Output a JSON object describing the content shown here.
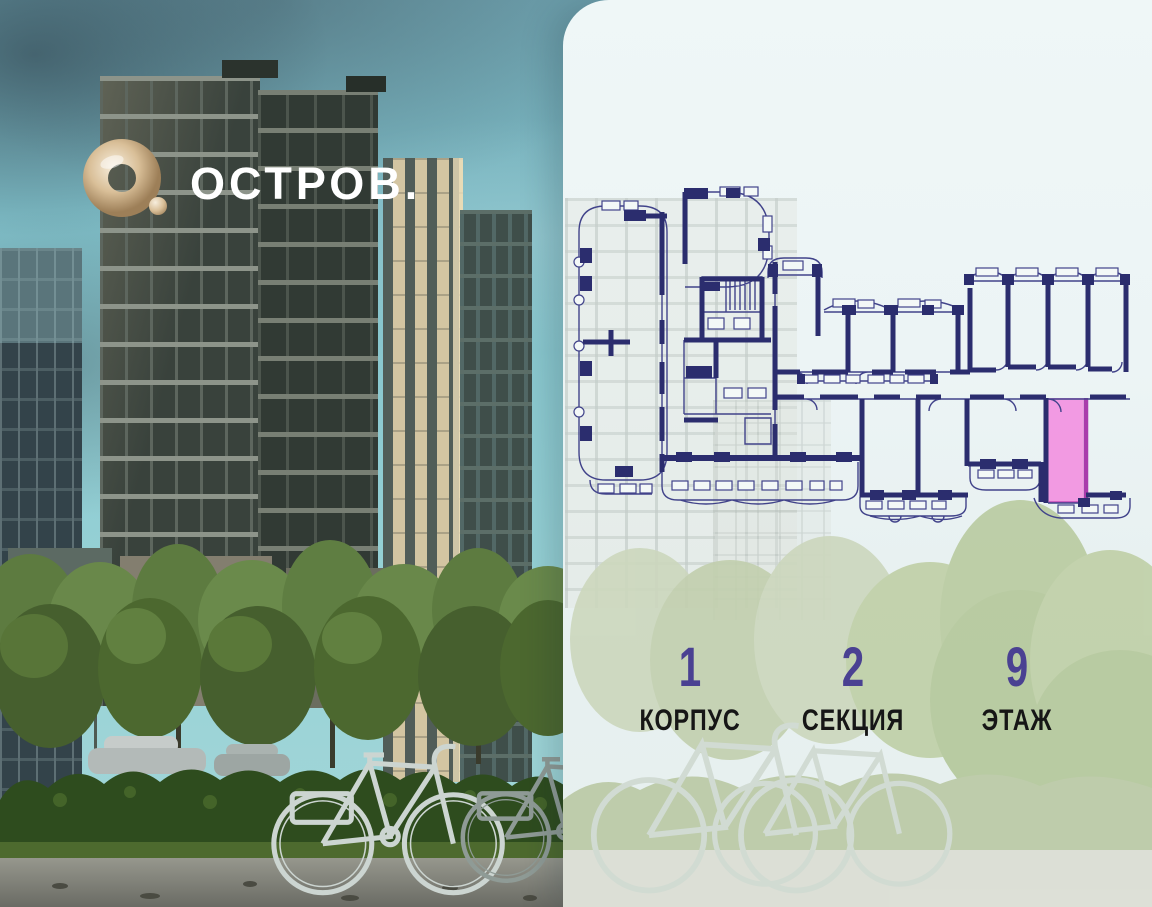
{
  "logo": {
    "text": "ОСТРОВ.",
    "mark": "gold-ring-and-dot",
    "mark_color": "#d9bf97",
    "text_color": "#ffffff"
  },
  "panel": {
    "background_color": "#ecf4f5"
  },
  "floor_plan": {
    "line_color": "#2b2d6e",
    "highlight_fill": "#f292e1",
    "highlight_stroke": "#a93cab",
    "highlighted_unit": "selected-apartment"
  },
  "stats": {
    "value_color": "#4a4192",
    "label_color": "#161616",
    "items": [
      {
        "value": "1",
        "label": "КОРПУС"
      },
      {
        "value": "2",
        "label": "СЕКЦИЯ"
      },
      {
        "value": "9",
        "label": "ЭТАЖ"
      }
    ]
  }
}
